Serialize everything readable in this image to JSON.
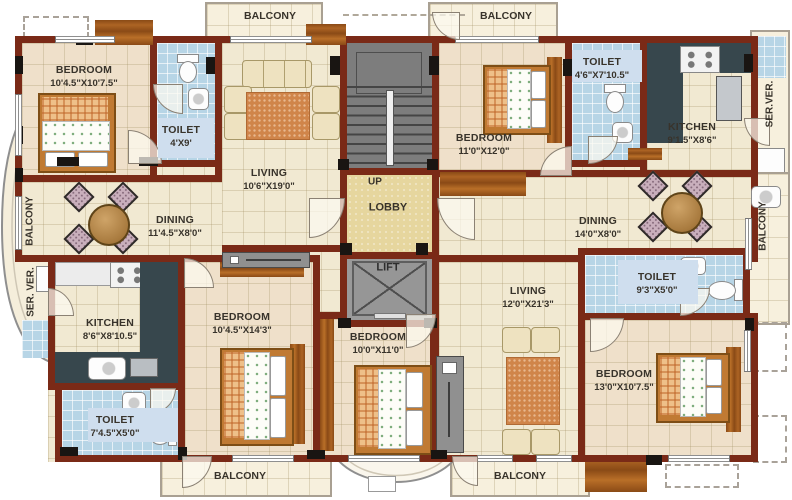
{
  "plan_title": "apartment-floor-plan",
  "core": {
    "lobby": "LOBBY",
    "lift": "LIFT",
    "up": "UP"
  },
  "rooms": {
    "bedroom_top_left": {
      "name": "BEDROOM",
      "dims": "10'4.5\"X10'7.5\""
    },
    "toilet_top_left": {
      "name": "TOILET",
      "dims": "4'X9'"
    },
    "living_left": {
      "name": "LIVING",
      "dims": "10'6\"X19'0\""
    },
    "dining_left": {
      "name": "DINING",
      "dims": "11'4.5\"X8'0\""
    },
    "kitchen_left": {
      "name": "KITCHEN",
      "dims": "8'6\"X8'10.5\""
    },
    "toilet_bottom_left": {
      "name": "TOILET",
      "dims": "7'4.5\"X5'0\""
    },
    "bedroom_bottom_left": {
      "name": "BEDROOM",
      "dims": "10'4.5\"X14'3\""
    },
    "bedroom_bottom_center": {
      "name": "BEDROOM",
      "dims": "10'0\"X11'0\""
    },
    "bedroom_top_right": {
      "name": "BEDROOM",
      "dims": "11'0\"X12'0\""
    },
    "toilet_top_right": {
      "name": "TOILET",
      "dims": "4'6\"X7'10.5\""
    },
    "kitchen_right": {
      "name": "KITCHEN",
      "dims": "9'1.5\"X8'6\""
    },
    "dining_right": {
      "name": "DINING",
      "dims": "14'0\"X8'0\""
    },
    "living_right": {
      "name": "LIVING",
      "dims": "12'0\"X21'3\""
    },
    "toilet_right": {
      "name": "TOILET",
      "dims": "9'3\"X5'0\""
    },
    "bedroom_bottom_right": {
      "name": "BEDROOM",
      "dims": "13'0\"X10'7.5\""
    }
  },
  "balconies": {
    "top_left": "BALCONY",
    "top_right": "BALCONY",
    "bottom_left": "BALCONY",
    "bottom_right": "BALCONY",
    "left_side": "BALCONY",
    "right_side": "BALCONY"
  },
  "service_verandah": {
    "left": "SER. VER.",
    "right": "SER.VER."
  },
  "colors": {
    "wall": "#7a2a17",
    "wood": "#a8601f",
    "floor_cream": "#f1e9d2",
    "floor_bedroom": "#efe0ca",
    "toilet_tile": "#b7d5e6",
    "kitchen_counter": "#37474d",
    "lobby_floor": "#e6d69e",
    "stair_gray": "#7d7d7d",
    "balcony_floor": "#f7f0dd",
    "serv_blue": "#b3cfe4"
  }
}
